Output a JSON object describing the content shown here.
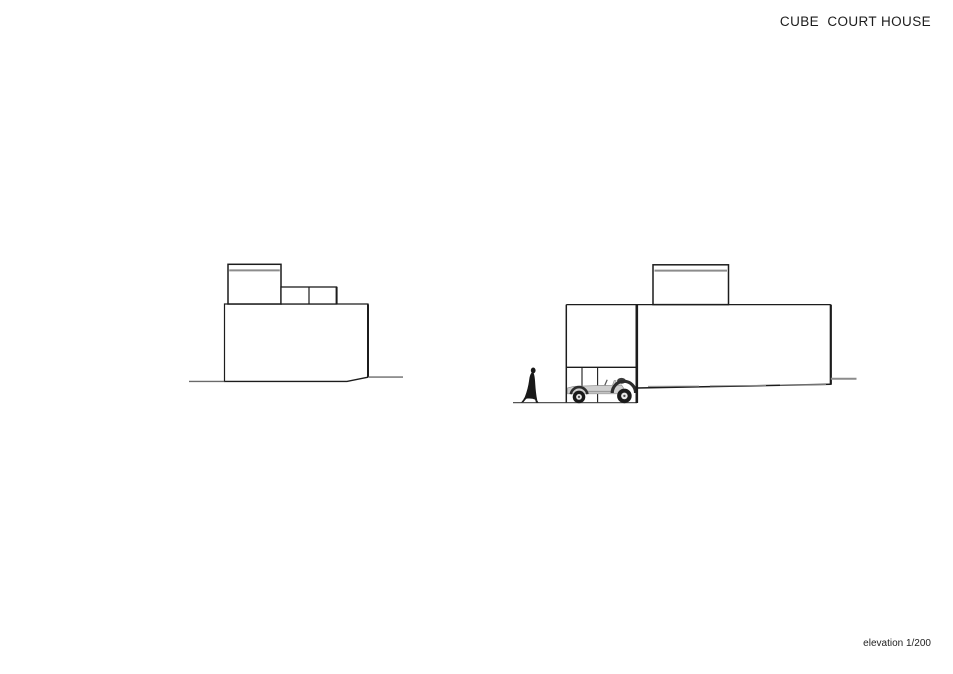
{
  "header": {
    "title": "CUBE  COURT HOUSE"
  },
  "footer": {
    "scale_label": "elevation 1/200"
  },
  "canvas": {
    "background": "#ffffff",
    "ink": "#1c1c1c",
    "gray_ink": "#8c8c8c",
    "ground_ink": "#555555"
  },
  "figures": {
    "person_icon": "walking-person-silhouette",
    "car_icon": "classic-roadster-silhouette",
    "left_drawing": "left-elevation",
    "right_drawing": "right-elevation"
  }
}
